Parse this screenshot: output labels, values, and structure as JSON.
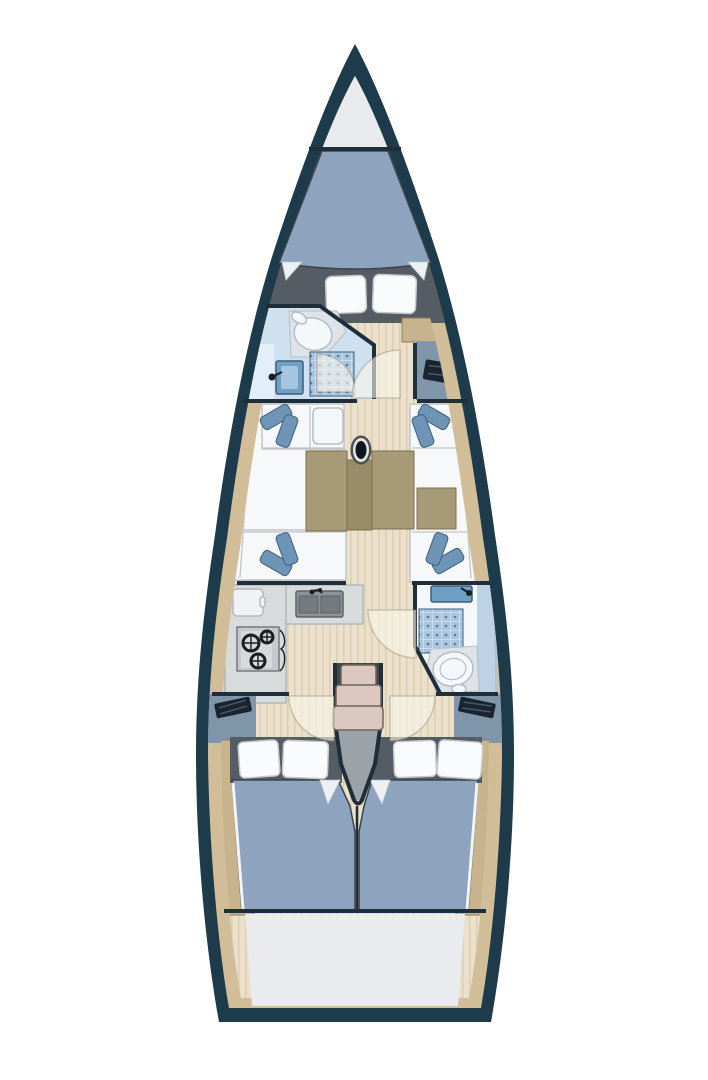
{
  "figure": {
    "kind": "sailboat-interior-floorplan",
    "orientation": "bow-up"
  },
  "colors": {
    "background": "#ffffff",
    "hull": "#1d3b4b",
    "wall": "#202e3a",
    "deck": "#d1be99",
    "floor": "#eae0cb",
    "floor_stripe": "#dcd0b2",
    "locker": "#e8eaed",
    "berth_bg": "#565c63",
    "mattress": "#8ea3be",
    "mattress_edge": "#3a444f",
    "pillow": "#fafbfc",
    "pillow_edge": "#c4c9ce",
    "white_fold": "#eef1f4",
    "sheet_sliver": "#f2f4f6",
    "head_room": "#cfe1f0",
    "head_counter": "#e2eef9",
    "fixture_white": "#f5f8fa",
    "fixture_edge": "#b7bdc2",
    "platform": "#dde3e8",
    "tile": "#a9c6e0",
    "tile_line": "#e6eff8",
    "tile_dot": "#5e7a95",
    "sink_blue": "#6fa0c4",
    "sink_edge": "#3f5d77",
    "sink_inner": "#a6c6e0",
    "desk_blue": "#7e95aa",
    "dark_item": "#1a2430",
    "dark_item_line": "#45586c",
    "cabinet_tan": "#c8b48c",
    "cabinet_edge": "#8d7c5a",
    "seat_white": "#f6f8f9",
    "seat_edge": "#bfc5c9",
    "cushion": "#6e94b6",
    "cushion_edge": "#3e607e",
    "table": "#a89a77",
    "table_center": "#9a8c69",
    "table_edge": "#7b6f52",
    "mast_dark": "#0d1621",
    "mast_ring": "#e9e5da",
    "mast_halo": "#4a5158",
    "counter": "#d8dbdc",
    "counter_edge": "#a9afb2",
    "fridge": "#eff1f2",
    "galley_sink": "#8d9397",
    "galley_sink_basin": "#747a7e",
    "galley_sink_edge": "#5d6367",
    "stove_body": "#c6cacc",
    "stove_panel": "#d7dadb",
    "burner": "#1b1e20",
    "steps": "#dcc8c0",
    "steps_edge": "#6e655b",
    "steps_back": "#41464d",
    "wedge": "#9ba2a8",
    "stern": "#e9ebee",
    "door_arc": "rgba(250,246,235,0.6)",
    "door_arc_edge": "rgba(130,120,95,0.35)"
  }
}
